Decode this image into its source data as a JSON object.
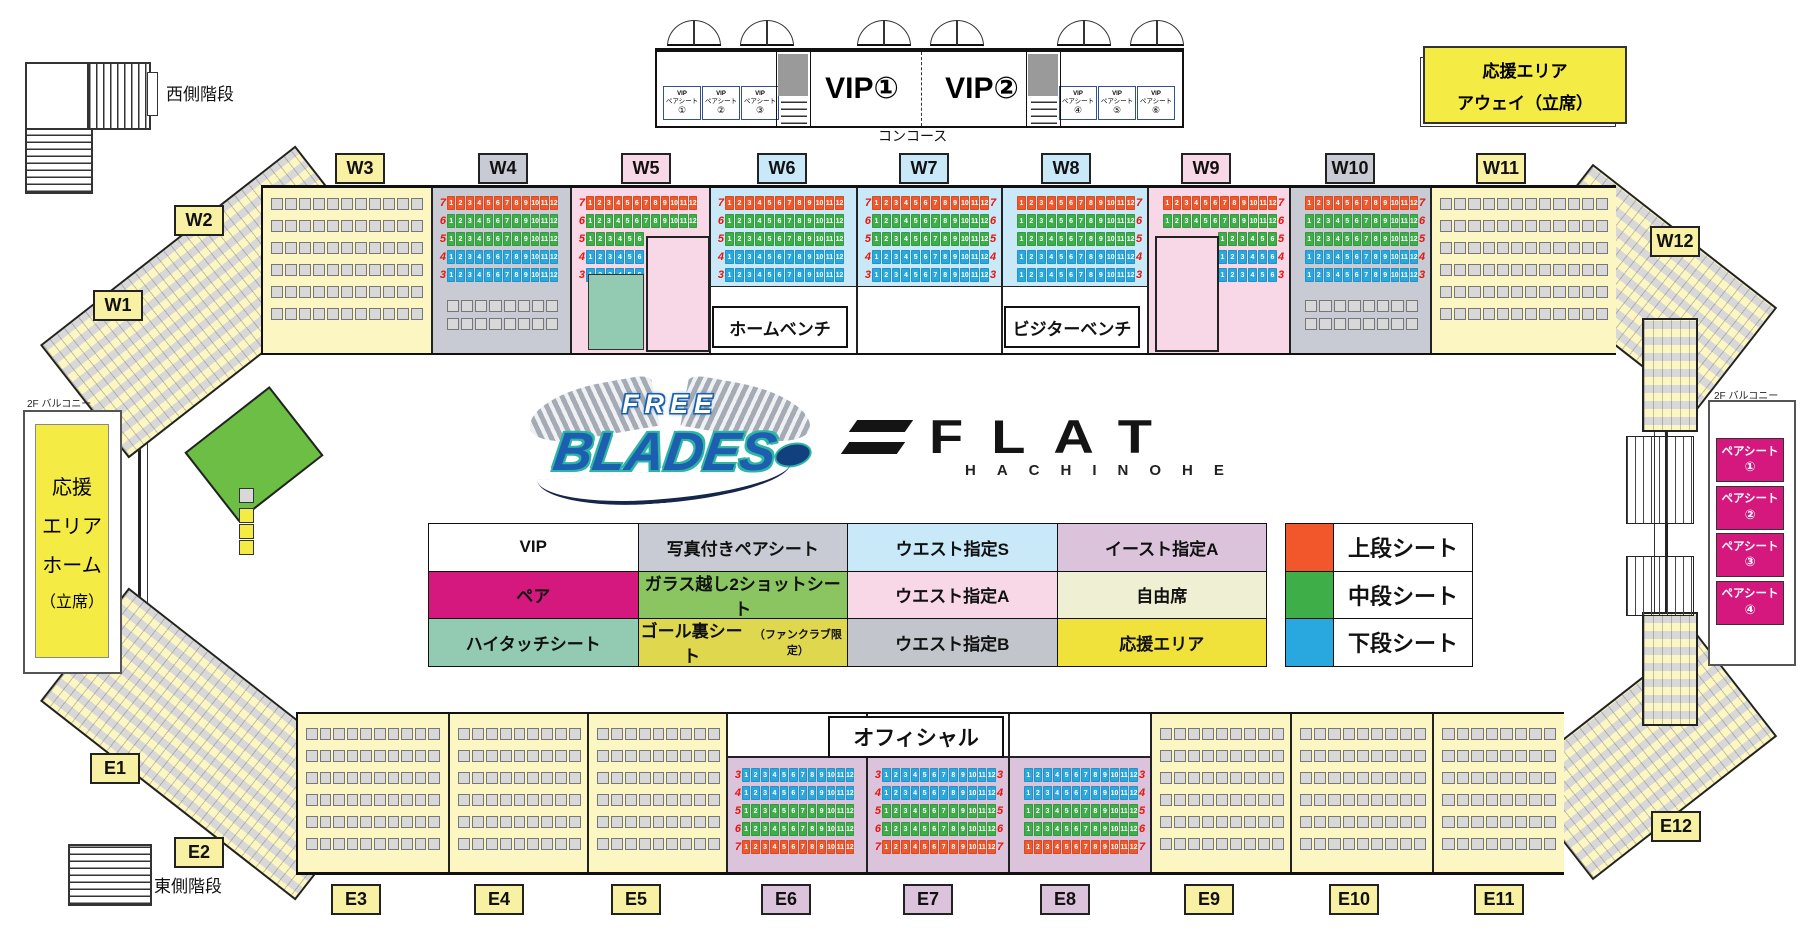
{
  "colors": {
    "yellow": "#FCF6C3",
    "labelYellow": "#F8F0A3",
    "gray": "#C8CBD3",
    "pink": "#F8D7E7",
    "blue": "#C9E9F9",
    "purple": "#DCC3DC",
    "mint": "#92CBB1",
    "magenta": "#D4187E",
    "seat": "#D8D8D8",
    "upper": "#F1572B",
    "middle": "#3EAE49",
    "lower": "#29A8E0",
    "red": "#E8150D",
    "cheerYellow": "#F5EB45",
    "white": "#FFFFFF",
    "glassGreen": "#6CBE45"
  },
  "top": {
    "west_stairs": "西側階段",
    "concourse": "コンコース",
    "vip1": "VIP①",
    "vip2": "VIP②",
    "vip_pair_title": "VIP",
    "vip_pair_sub": "ペアシート",
    "vip_pair_left": [
      "①",
      "②",
      "③"
    ],
    "vip_pair_right": [
      "④",
      "⑤",
      "⑥"
    ],
    "away_line1": "応援エリア",
    "away_line2": "アウェイ（立席）"
  },
  "left_area": {
    "balcony": "2F バルコニー",
    "lines": [
      "応援",
      "エリア",
      "ホーム",
      "（立席）"
    ]
  },
  "right_area": {
    "balcony": "2F バルコニー",
    "pair_label": "ペアシート",
    "pair_nums": [
      "①",
      "②",
      "③",
      "④"
    ]
  },
  "bottom": {
    "east_stairs": "東側階段",
    "official": "オフィシャル"
  },
  "rink": {
    "home_bench": "ホームベンチ",
    "visitor_bench": "ビジターベンチ"
  },
  "logos": {
    "free": "FREE",
    "blades": "BLADES",
    "flat": "FLAT",
    "hachinohe": "HACHINOHE"
  },
  "legend": {
    "rows": [
      [
        {
          "label": "VIP",
          "bg": "#FFFFFF"
        },
        {
          "label": "写真付きペアシート",
          "bg": "#C8CBD3"
        },
        {
          "label": "ウエスト指定S",
          "bg": "#C9E9F9"
        },
        {
          "label": "イースト指定A",
          "bg": "#DCC3DC"
        }
      ],
      [
        {
          "label": "ペア",
          "bg": "#D4187E"
        },
        {
          "label": "ガラス越し2ショットシート",
          "bg": "#8BC561"
        },
        {
          "label": "ウエスト指定A",
          "bg": "#F8D7E7"
        },
        {
          "label": "自由席",
          "bg": "#EFF0D3"
        }
      ],
      [
        {
          "label": "ハイタッチシート",
          "bg": "#92CBB1"
        },
        {
          "label": "ゴール裏シート",
          "suffix": "（ファンクラブ限定）",
          "bg": "#DFD84F"
        },
        {
          "label": "ウエスト指定B",
          "bg": "#C2C5CB"
        },
        {
          "label": "応援エリア",
          "bg": "#F0E23B"
        }
      ]
    ],
    "tiers": [
      {
        "label": "上段シート",
        "color": "#F1572B"
      },
      {
        "label": "中段シート",
        "color": "#3EAE49"
      },
      {
        "label": "下段シート",
        "color": "#29A8E0"
      }
    ]
  },
  "section_labels": {
    "west": [
      {
        "id": "W1",
        "x": 93,
        "y": 290,
        "bg": "labelYellow"
      },
      {
        "id": "W2",
        "x": 174,
        "y": 205,
        "bg": "labelYellow"
      },
      {
        "id": "W3",
        "x": 335,
        "y": 153,
        "bg": "labelYellow"
      },
      {
        "id": "W4",
        "x": 478,
        "y": 153,
        "bg": "gray"
      },
      {
        "id": "W5",
        "x": 621,
        "y": 153,
        "bg": "pink"
      },
      {
        "id": "W6",
        "x": 757,
        "y": 153,
        "bg": "blue"
      },
      {
        "id": "W7",
        "x": 899,
        "y": 153,
        "bg": "blue"
      },
      {
        "id": "W8",
        "x": 1041,
        "y": 153,
        "bg": "blue"
      },
      {
        "id": "W9",
        "x": 1181,
        "y": 153,
        "bg": "pink"
      },
      {
        "id": "W10",
        "x": 1325,
        "y": 153,
        "bg": "gray"
      },
      {
        "id": "W11",
        "x": 1476,
        "y": 153,
        "bg": "labelYellow"
      },
      {
        "id": "W12",
        "x": 1650,
        "y": 226,
        "bg": "labelYellow"
      }
    ],
    "east": [
      {
        "id": "E1",
        "x": 90,
        "y": 753,
        "bg": "labelYellow"
      },
      {
        "id": "E2",
        "x": 174,
        "y": 837,
        "bg": "labelYellow"
      },
      {
        "id": "E3",
        "x": 331,
        "y": 884,
        "bg": "labelYellow"
      },
      {
        "id": "E4",
        "x": 474,
        "y": 884,
        "bg": "labelYellow"
      },
      {
        "id": "E5",
        "x": 611,
        "y": 884,
        "bg": "labelYellow"
      },
      {
        "id": "E6",
        "x": 761,
        "y": 884,
        "bg": "purple"
      },
      {
        "id": "E7",
        "x": 903,
        "y": 884,
        "bg": "purple"
      },
      {
        "id": "E8",
        "x": 1040,
        "y": 884,
        "bg": "purple"
      },
      {
        "id": "E9",
        "x": 1184,
        "y": 884,
        "bg": "labelYellow"
      },
      {
        "id": "E10",
        "x": 1329,
        "y": 884,
        "bg": "labelYellow"
      },
      {
        "id": "E11",
        "x": 1474,
        "y": 884,
        "bg": "labelYellow"
      },
      {
        "id": "E12",
        "x": 1651,
        "y": 811,
        "bg": "labelYellow"
      }
    ]
  },
  "seat_map": {
    "seats_per_row": 12,
    "top_band": {
      "x": 261,
      "y": 185,
      "w": 1351,
      "h": 165,
      "row_nums": [
        "7",
        "6",
        "5",
        "4",
        "3"
      ],
      "strip_tiers": [
        "upper",
        "middle",
        "middle",
        "lower",
        "lower"
      ],
      "sections": [
        {
          "id": "W3",
          "x": 0,
          "w": 168,
          "bg": "yellow",
          "type": "free"
        },
        {
          "id": "W4",
          "x": 168,
          "w": 139,
          "bg": "gray",
          "type": "strips",
          "nums": "left",
          "extra": "grayrows"
        },
        {
          "id": "W5",
          "x": 307,
          "w": 139,
          "bg": "pink",
          "type": "strips",
          "nums": "left",
          "trunc": "left",
          "room": "right",
          "mint": true
        },
        {
          "id": "W6",
          "x": 446,
          "w": 147,
          "bg": "blue",
          "type": "strips",
          "nums": "left",
          "lower": "white"
        },
        {
          "id": "W7",
          "x": 593,
          "w": 145,
          "bg": "blue",
          "type": "strips",
          "nums": "both",
          "lower": "white"
        },
        {
          "id": "W8",
          "x": 738,
          "w": 146,
          "bg": "blue",
          "type": "strips",
          "nums": "right",
          "lower": "white"
        },
        {
          "id": "W9",
          "x": 884,
          "w": 142,
          "bg": "pink",
          "type": "strips",
          "nums": "right",
          "trunc": "right",
          "room": "left"
        },
        {
          "id": "W10",
          "x": 1026,
          "w": 141,
          "bg": "gray",
          "type": "strips",
          "nums": "right",
          "extra": "grayrows"
        },
        {
          "id": "W11",
          "x": 1167,
          "w": 184,
          "bg": "yellow",
          "type": "free"
        }
      ]
    },
    "bottom_band": {
      "x": 296,
      "y": 712,
      "w": 1264,
      "h": 158,
      "row_nums": [
        "3",
        "4",
        "5",
        "6",
        "7"
      ],
      "strip_tiers": [
        "lower",
        "lower",
        "middle",
        "middle",
        "upper"
      ],
      "sections": [
        {
          "id": "E3",
          "x": 0,
          "w": 150,
          "bg": "yellow",
          "type": "free"
        },
        {
          "id": "E4",
          "x": 150,
          "w": 139,
          "bg": "yellow",
          "type": "free"
        },
        {
          "id": "E5",
          "x": 289,
          "w": 139,
          "bg": "yellow",
          "type": "free"
        },
        {
          "id": "E6",
          "x": 428,
          "w": 140,
          "bg": "purple",
          "type": "strips",
          "nums": "left",
          "inset": true
        },
        {
          "id": "E7",
          "x": 568,
          "w": 142,
          "bg": "purple",
          "type": "strips",
          "nums": "both",
          "inset": true
        },
        {
          "id": "E8",
          "x": 710,
          "w": 142,
          "bg": "purple",
          "type": "strips",
          "nums": "right",
          "inset": true
        },
        {
          "id": "E9",
          "x": 852,
          "w": 140,
          "bg": "yellow",
          "type": "free"
        },
        {
          "id": "E10",
          "x": 992,
          "w": 142,
          "bg": "yellow",
          "type": "free"
        },
        {
          "id": "E11",
          "x": 1134,
          "w": 130,
          "bg": "yellow",
          "type": "free"
        }
      ]
    }
  }
}
